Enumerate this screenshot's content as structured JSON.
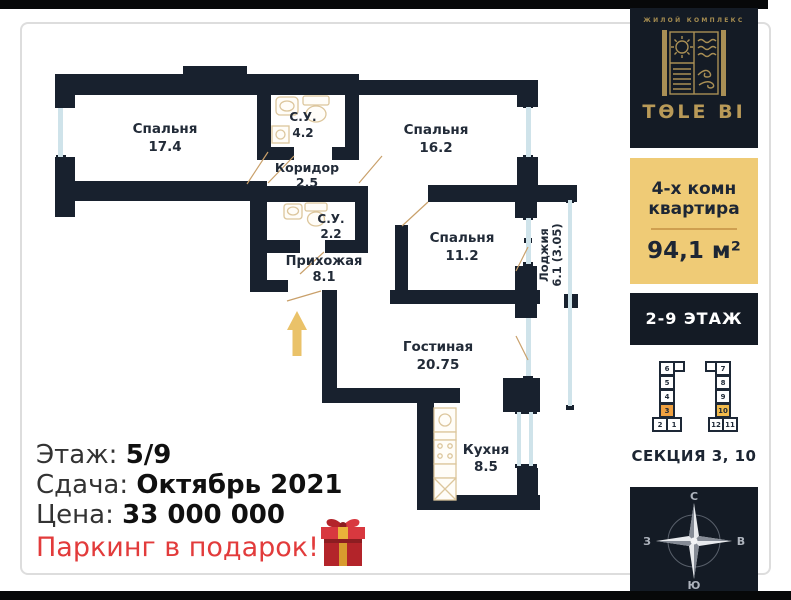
{
  "plan": {
    "rooms": [
      {
        "name": "Спальня",
        "area": "17.4"
      },
      {
        "name": "С.У.",
        "area": "4.2"
      },
      {
        "name": "Спальня",
        "area": "16.2"
      },
      {
        "name": "Коридор",
        "area": "2.5"
      },
      {
        "name": "С.У.",
        "area": "2.2"
      },
      {
        "name": "Спальня",
        "area": "11.2"
      },
      {
        "name": "Прихожая",
        "area": "8.1"
      },
      {
        "name": "Гостиная",
        "area": "20.75"
      },
      {
        "name": "Кухня",
        "area": "8.5"
      },
      {
        "name": "Лоджия",
        "area": "6.1 (3.05)"
      }
    ]
  },
  "sidebar": {
    "brand": {
      "tagline": "ЖИЛОЙ КОМПЛЕКС",
      "name": "TӨLE BI"
    },
    "apartment": {
      "line1": "4-х комн",
      "line2": "квартира",
      "area": "94,1 м²"
    },
    "floors": "2-9 ЭТАЖ",
    "section": "СЕКЦИЯ 3, 10",
    "site_plan": {
      "blocks": [
        {
          "n": "6"
        },
        {
          "n": "5"
        },
        {
          "n": "4"
        },
        {
          "n": "3"
        },
        {
          "n": "2"
        },
        {
          "n": "1"
        },
        {
          "n": "7"
        },
        {
          "n": "8"
        },
        {
          "n": "9"
        },
        {
          "n": "10"
        },
        {
          "n": "12"
        },
        {
          "n": "11"
        }
      ],
      "highlighted": "3, 10"
    },
    "compass": {
      "n": "С",
      "e": "В",
      "s": "Ю",
      "w": "З"
    }
  },
  "details": {
    "floor_label": "Этаж:",
    "floor_value": "5/9",
    "completion_label": "Сдача:",
    "completion_value": "Октябрь 2021",
    "price_label": "Цена:",
    "price_value": "33 000 000",
    "promo": "Паркинг в подарок!"
  },
  "colors": {
    "wall": "#18212e",
    "panel_dark": "#141b25",
    "panel_gold": "#efcb76",
    "brand_gold": "#b99a58",
    "window_blue": "#cfe3ea",
    "fixture_tan": "#dcc69c",
    "arrow_gold": "#eac269",
    "promo_red": "#e23b3b",
    "highlight_orange": "#f0a648"
  }
}
